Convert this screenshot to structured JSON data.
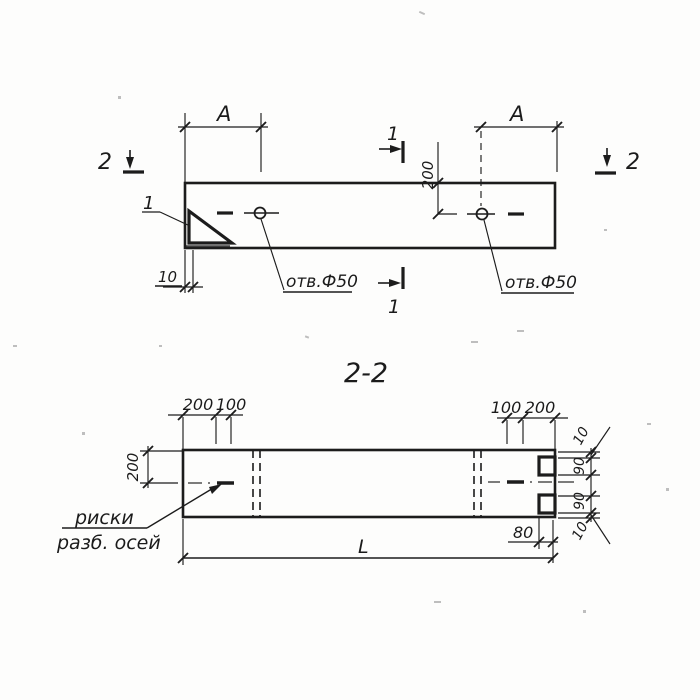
{
  "section_title": "2-2",
  "top_view": {
    "dim_a_left": "A",
    "dim_a_right": "A",
    "dim_offset_200": "200",
    "section_cut_1_top": "1",
    "section_cut_1_bottom": "1",
    "section_cut_2_left": "2",
    "section_cut_2_right": "2",
    "detail_ref_1": "1",
    "dim_10": "10",
    "hole_label_left": "отв.Ф50",
    "hole_label_right": "отв.Ф50"
  },
  "section_view": {
    "dim_top_left_200": "200",
    "dim_top_left_100": "100",
    "dim_top_right_100": "100",
    "dim_top_right_200": "200",
    "dim_left_200": "200",
    "dim_right_10_top": "10",
    "dim_right_90_top": "90",
    "dim_right_90_bottom": "90",
    "dim_right_10_bottom": "10",
    "dim_80": "80",
    "dim_length": "L",
    "axis_marks_label_line1": "риски",
    "axis_marks_label_line2": "разб. осей"
  }
}
